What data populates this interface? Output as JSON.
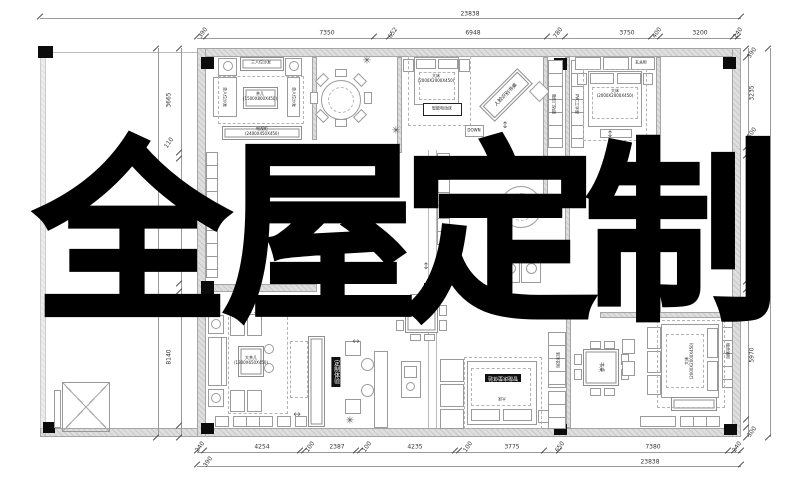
{
  "overlay": {
    "text": "全屋定制",
    "chars": [
      {
        "c": "全",
        "x": 132
      },
      {
        "c": "屋",
        "x": 320
      },
      {
        "c": "定",
        "x": 500
      },
      {
        "c": "制",
        "x": 682
      }
    ]
  },
  "colors": {
    "paper": "#ffffff",
    "wall_fill": "#dedede",
    "drawing_line": "#9b9b9b",
    "dimension_text": "#333333",
    "overlay_text": "#000000",
    "label_badge_bg": "#101010",
    "label_badge_text": "#ffffff"
  },
  "dimensions": {
    "top": {
      "overall": {
        "v": "23838",
        "x": 470,
        "y": 14
      },
      "segments": [
        {
          "v": "390",
          "x": 203
        },
        {
          "v": "7350",
          "x": 327
        },
        {
          "v": "652",
          "x": 393
        },
        {
          "v": "6948",
          "x": 473
        },
        {
          "v": "780",
          "x": 558
        },
        {
          "v": "3750",
          "x": 627
        },
        {
          "v": "400",
          "x": 657
        },
        {
          "v": "3200",
          "x": 700
        },
        {
          "v": "240",
          "x": 738
        }
      ]
    },
    "bottom": {
      "overall": {
        "v": "23838",
        "x": 650,
        "y": 462
      },
      "extra": {
        "v": "390",
        "x": 208,
        "y": 462
      },
      "segments": [
        {
          "v": "240",
          "x": 200
        },
        {
          "v": "4254",
          "x": 262
        },
        {
          "v": "100",
          "x": 310
        },
        {
          "v": "2387",
          "x": 337
        },
        {
          "v": "100",
          "x": 367
        },
        {
          "v": "4235",
          "x": 415
        },
        {
          "v": "100",
          "x": 468
        },
        {
          "v": "3775",
          "x": 512
        },
        {
          "v": "650",
          "x": 560
        },
        {
          "v": "7380",
          "x": 653
        },
        {
          "v": "240",
          "x": 737
        }
      ]
    },
    "left": {
      "segments": [
        {
          "v": "3665",
          "y": 100
        },
        {
          "v": "110",
          "y": 143
        },
        {
          "v": "8140",
          "y": 357
        }
      ]
    },
    "right": {
      "overall": {
        "v": "17360",
        "x": 767,
        "y": 243
      },
      "segments": [
        {
          "v": "390",
          "y": 53
        },
        {
          "v": "3235",
          "y": 93
        },
        {
          "v": "500",
          "y": 133
        },
        {
          "v": "6375",
          "y": 212
        },
        {
          "v": "100",
          "y": 290
        },
        {
          "v": "5970",
          "y": 355
        },
        {
          "v": "300",
          "y": 432
        }
      ]
    }
  },
  "labels": [
    {
      "text": "三人位沙发",
      "x": 261,
      "y": 63,
      "fs": 4,
      "rot": 0,
      "style": "plain"
    },
    {
      "text": "单人位沙发",
      "x": 224,
      "y": 97,
      "fs": 4,
      "rot": 90,
      "style": "plain"
    },
    {
      "text": "单人位沙发",
      "x": 293,
      "y": 97,
      "fs": 4,
      "rot": 90,
      "style": "plain"
    },
    {
      "text": "茶几\n(1500X800X450)",
      "x": 260,
      "y": 97,
      "fs": 4,
      "rot": 0,
      "style": "plain"
    },
    {
      "text": "电视柜\n(2400X450X450)",
      "x": 262,
      "y": 132,
      "fs": 4,
      "rot": 0,
      "style": "plain"
    },
    {
      "text": "大床\n(2000X2000X450)",
      "x": 436,
      "y": 79,
      "fs": 4,
      "rot": 0,
      "style": "plain"
    },
    {
      "text": "智能电动床",
      "x": 442,
      "y": 109,
      "fs": 4,
      "rot": 0,
      "style": "plain"
    },
    {
      "text": "DOWN",
      "x": 474,
      "y": 131,
      "fs": 4,
      "rot": 0,
      "style": "plain"
    },
    {
      "text": "人脸识别书桌",
      "x": 506,
      "y": 95,
      "fs": 5,
      "rot": -45,
      "style": "plain"
    },
    {
      "text": "大床\n(2000X2000X450)",
      "x": 615,
      "y": 94,
      "fs": 4,
      "rot": 0,
      "style": "plain"
    },
    {
      "text": "玄关柜",
      "x": 641,
      "y": 63,
      "fs": 4,
      "rot": 0,
      "style": "plain"
    },
    {
      "text": "隐形门轨道",
      "x": 553,
      "y": 104,
      "fs": 4,
      "rot": 90,
      "style": "plain"
    },
    {
      "text": "PVC工字型",
      "x": 576,
      "y": 104,
      "fs": 4,
      "rot": 90,
      "style": "plain"
    },
    {
      "text": "大茶几\n(1300X650X450)",
      "x": 251,
      "y": 361,
      "fs": 4,
      "rot": 0,
      "style": "plain"
    },
    {
      "text": "定制体验",
      "x": 336,
      "y": 372,
      "fs": 6,
      "rot": 0,
      "style": "blackv"
    },
    {
      "text": "餐桌",
      "x": 421,
      "y": 317,
      "fs": 4,
      "rot": 0,
      "style": "plain"
    },
    {
      "text": "智能床垫体验",
      "x": 503,
      "y": 378,
      "fs": 5,
      "rot": 180,
      "style": "black"
    },
    {
      "text": "大床",
      "x": 502,
      "y": 398,
      "fs": 4,
      "rot": 180,
      "style": "plain"
    },
    {
      "text": "书桌",
      "x": 601,
      "y": 367,
      "fs": 5,
      "rot": 90,
      "style": "plain"
    },
    {
      "text": "大床\n(2000X2000X450)",
      "x": 690,
      "y": 361,
      "fs": 4,
      "rot": -90,
      "style": "plain"
    },
    {
      "text": "到顶衣柜",
      "x": 557,
      "y": 360,
      "fs": 4,
      "rot": 90,
      "style": "plain"
    },
    {
      "text": "组合酒柜",
      "x": 727,
      "y": 351,
      "fs": 4,
      "rot": 90,
      "style": "plain"
    }
  ],
  "plants": [
    {
      "x": 367,
      "y": 61
    },
    {
      "x": 396,
      "y": 131
    },
    {
      "x": 395,
      "y": 259
    },
    {
      "x": 210,
      "y": 304
    },
    {
      "x": 690,
      "y": 281
    },
    {
      "x": 350,
      "y": 421
    }
  ],
  "arrows": [
    {
      "g": "↕",
      "x": 505,
      "y": 126
    },
    {
      "g": "↕",
      "x": 426,
      "y": 267
    },
    {
      "g": "↔",
      "x": 297,
      "y": 415
    },
    {
      "g": "↔",
      "x": 356,
      "y": 342
    },
    {
      "g": "↕",
      "x": 610,
      "y": 135
    }
  ],
  "ticks": {
    "h": [
      {
        "y": 36,
        "xs": [
          197,
          206,
          374,
          389,
          547,
          565,
          651,
          660,
          733,
          738
        ]
      },
      {
        "y": 450,
        "xs": [
          197,
          204,
          300,
          304,
          356,
          360,
          455,
          459,
          544,
          559,
          728,
          734,
          741
        ]
      },
      {
        "y": 16,
        "xs": [
          40,
          741
        ]
      },
      {
        "y": 464,
        "xs": [
          197,
          741
        ]
      }
    ],
    "v": [
      {
        "x": 179,
        "ys": [
          48,
          152,
          158,
          283,
          291,
          425,
          437
        ]
      },
      {
        "x": 746,
        "ys": [
          48,
          57,
          147,
          155,
          281,
          289,
          297,
          419,
          427,
          437
        ]
      },
      {
        "x": 156,
        "ys": [
          48,
          437
        ]
      },
      {
        "x": 768,
        "ys": [
          48,
          437
        ]
      }
    ]
  }
}
